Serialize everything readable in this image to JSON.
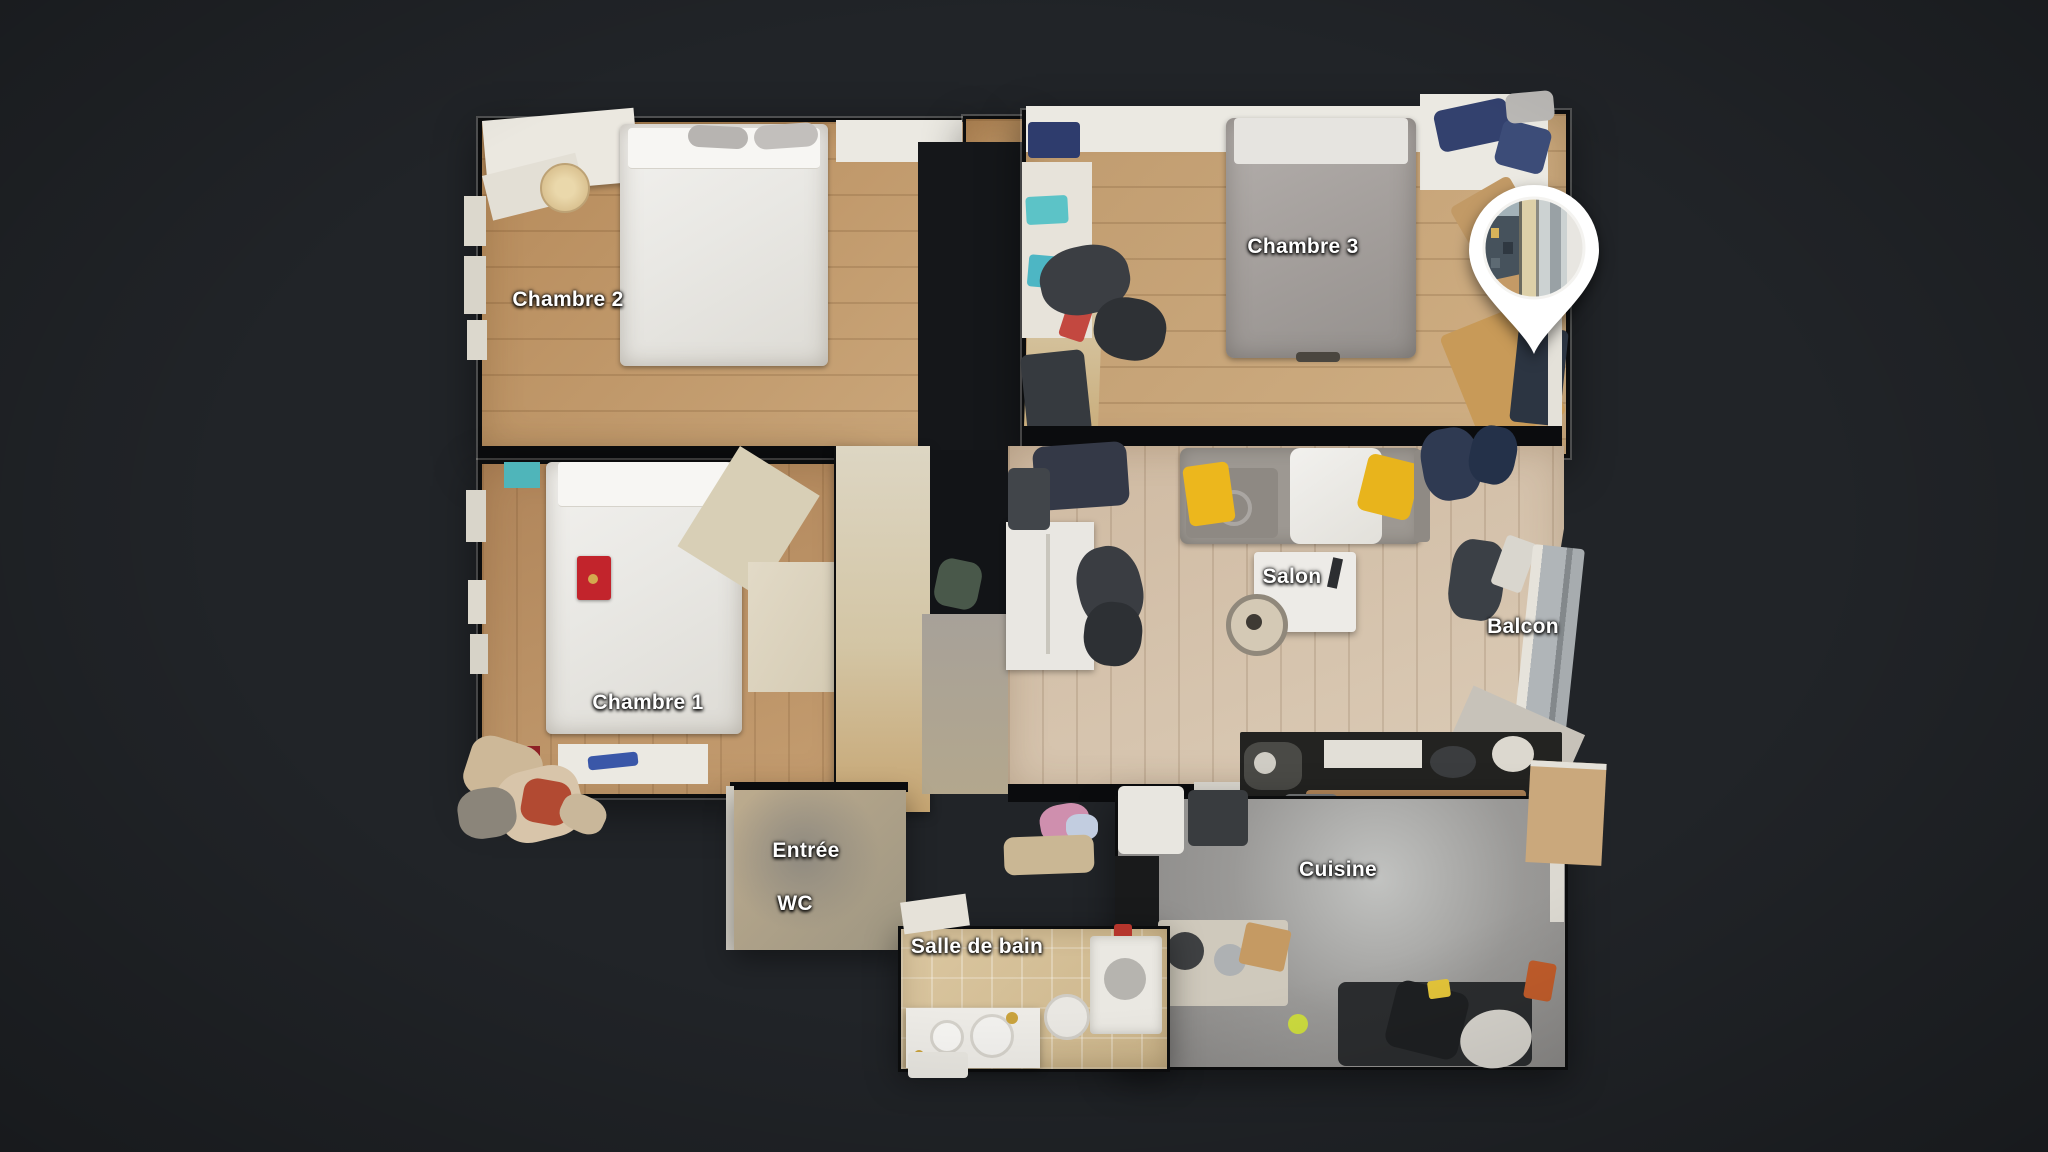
{
  "app": {
    "view_name": "floorplan-dollhouse-view",
    "background_color": "#212428"
  },
  "rooms": [
    {
      "id": "chambre-2",
      "label": "Chambre 2"
    },
    {
      "id": "chambre-3",
      "label": "Chambre 3"
    },
    {
      "id": "chambre-1",
      "label": "Chambre 1"
    },
    {
      "id": "salon",
      "label": "Salon"
    },
    {
      "id": "balcon",
      "label": "Balcon"
    },
    {
      "id": "entree",
      "label": "Entrée"
    },
    {
      "id": "wc",
      "label": "WC"
    },
    {
      "id": "salle-de-bain",
      "label": "Salle de bain"
    },
    {
      "id": "cuisine",
      "label": "Cuisine"
    }
  ],
  "pin": {
    "icon": "panorama-location-pin",
    "thumbnail": "window-view-photo",
    "color": "#ffffff"
  },
  "colors": {
    "label_text": "#ffffff",
    "label_outline": "#000000",
    "wood_floor": "#c09b6e",
    "light_wood_floor": "#d2bfa8",
    "kitchen_floor": "#9a9997",
    "bathroom_tile": "#d3bd96",
    "wall": "#0b0c0e",
    "accent_cushion": "#e9b51e",
    "accent_book": "#c2242c"
  }
}
